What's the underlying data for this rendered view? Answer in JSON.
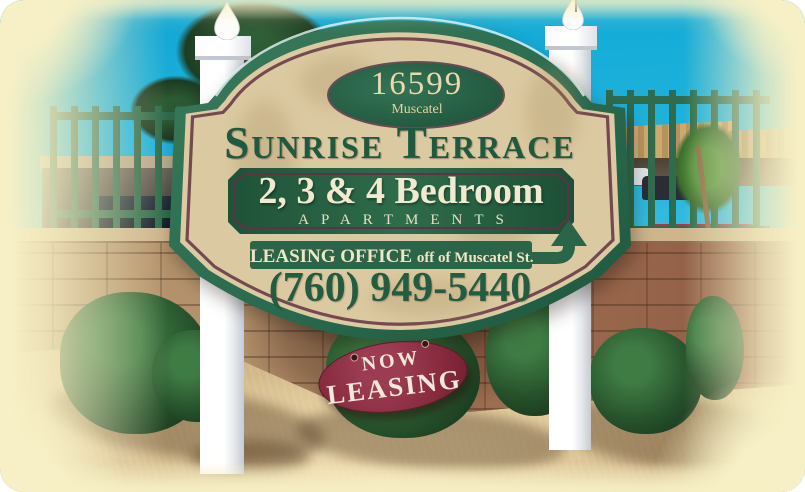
{
  "sign_board": {
    "address_oval": {
      "number": "16599",
      "street": "Muscatel"
    },
    "title": "Sunrise Terrace",
    "panel": {
      "line1": "2, 3 & 4 Bedroom",
      "line2": "APARTMENTS"
    },
    "leasing_bar": {
      "label": "LEASING OFFICE",
      "direction": "off of Muscatel St.",
      "arrow_icon": "up-arrow"
    },
    "phone": "(760) 949-5440"
  },
  "hanging_oval": {
    "line1": "NOW",
    "line2": "LEASING"
  },
  "colors": {
    "board_green": "#2c6b4e",
    "trim_maroon": "#744a50",
    "board_cream": "#dbc9a1",
    "panel_green": "#265c41",
    "oval_maroon": "#84283c",
    "text_dark_green": "#235c41",
    "text_cream": "#efe6c4",
    "post_white": "#f7f8fa",
    "sky_cyan": "#25b6dd",
    "sand_tan": "#d8bf90"
  }
}
